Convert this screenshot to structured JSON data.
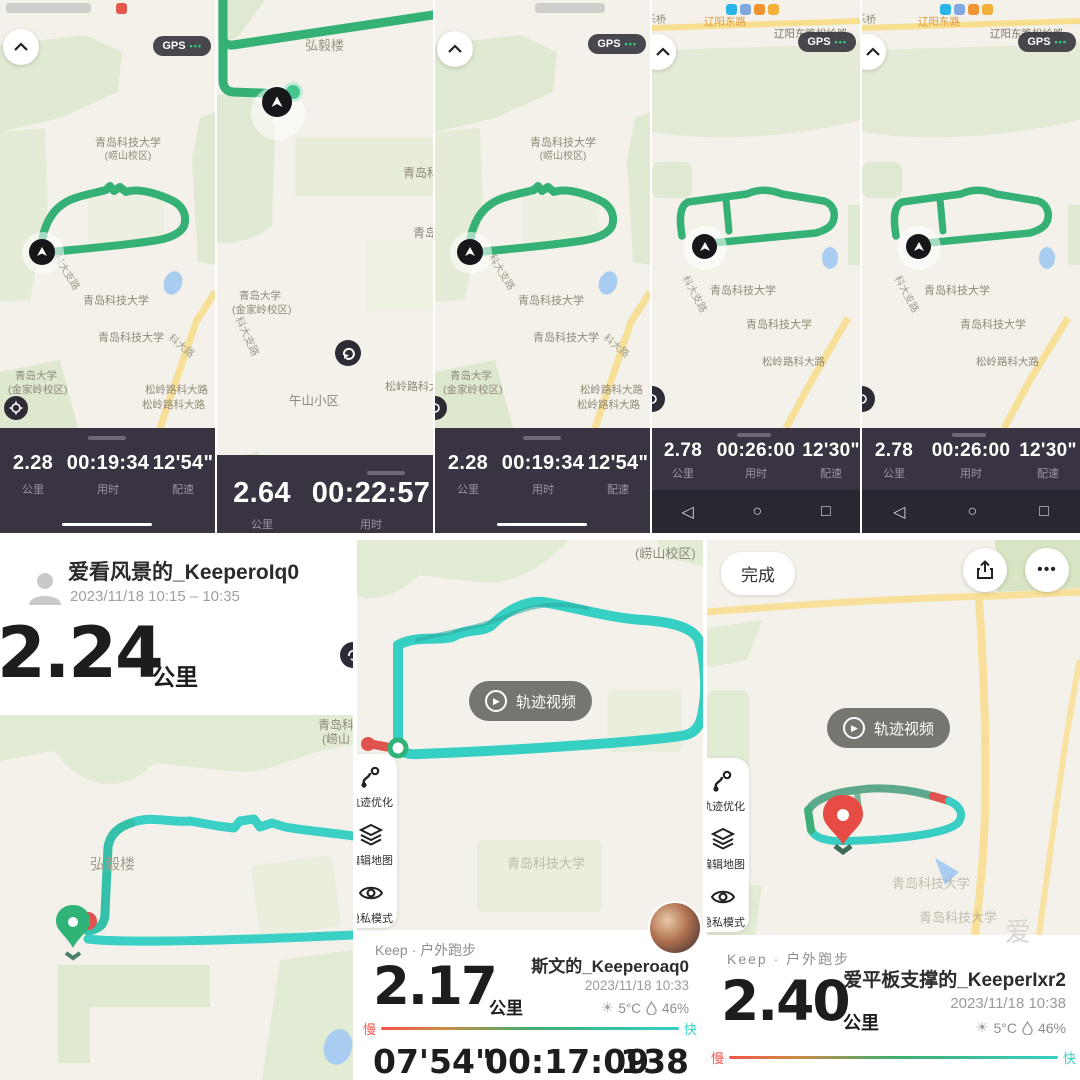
{
  "colors": {
    "keep_green": "#36b176",
    "track_cyan": "#35d0c5",
    "stats_bg": "#3a3442",
    "accent_red": "#f4524a",
    "map_bg": "#f4f1ea",
    "road_yellow": "#f7e09a"
  },
  "p1": {
    "gps": "GPS",
    "dots": "•••",
    "campus1": "青岛科技大学",
    "campus2": "(崂山校区)",
    "uni_a": "青岛科技大学",
    "uni_b": "青岛科技大学",
    "qdu_a": "青岛大学",
    "qdu_b": "(金家岭校区)",
    "road_kedazhilu": "科大支路",
    "road_kedalu": "科大路",
    "road_songling_a": "松岭路科大路",
    "road_songling_b": "松岭路科大路",
    "dist": "2.28",
    "dist_label": "公里",
    "dur": "00:19:34",
    "dur_label": "用时",
    "pace": "12'54\"",
    "pace_label": "配速"
  },
  "p2": {
    "building": "弘毅楼",
    "uni_right": "青岛科技大",
    "uni_cut": "青岛大",
    "qdu_a": "青岛大学",
    "qdu_b": "(金家岭校区)",
    "road_kedazhilu": "科大支路",
    "village": "午山小区",
    "road_songling": "松岭路科大路",
    "dist": "2.64",
    "dist_label": "公里",
    "dur": "00:22:57",
    "dur_label": "用时"
  },
  "p3": {
    "gps": "GPS",
    "dots": "•••",
    "campus1": "青岛科技大学",
    "campus2": "(崂山校区)",
    "uni_a": "青岛科技大学",
    "uni_b": "青岛科技大学",
    "qdu_a": "青岛大学",
    "qdu_b": "(金家岭校区)",
    "road_kedazhilu": "科大支路",
    "road_kedalu": "科大路",
    "road_songling_a": "松岭路科大路",
    "road_songling_b": "松岭路科大路",
    "dist": "2.28",
    "dist_label": "公里",
    "dur": "00:19:34",
    "dur_label": "用时",
    "pace": "12'54\"",
    "pace_label": "配速"
  },
  "p4": {
    "left_road": "乐桥",
    "road_top": "辽阳东路",
    "road_top2": "辽阳东路松岭路",
    "gps": "GPS",
    "dots": "•••",
    "uni_a": "青岛科技大学",
    "uni_b": "青岛科技大学",
    "road_kedazhilu": "科大支路",
    "road_songling": "松岭路科大路",
    "dist": "2.78",
    "dist_label": "公里",
    "dur": "00:26:00",
    "dur_label": "用时",
    "pace": "12'30\"",
    "pace_label": "配速",
    "nav_back": "◁",
    "nav_home": "○",
    "nav_recent": "□"
  },
  "p5": {
    "left_road": "乐桥",
    "road_top": "辽阳东路",
    "road_top2": "辽阳东路松岭路",
    "gps": "GPS",
    "dots": "•••",
    "uni_a": "青岛科技大学",
    "uni_b": "青岛科技大学",
    "road_kedazhilu": "科大支路",
    "road_songling": "松岭路科大路",
    "dist": "2.78",
    "dist_label": "公里",
    "dur": "00:26:00",
    "dur_label": "用时",
    "pace": "12'30\"",
    "pace_label": "配速",
    "nav_back": "◁",
    "nav_home": "○",
    "nav_recent": "□"
  },
  "b1": {
    "username": "爱看风景的_KeeperoIq0",
    "daterange": "2023/11/18 10:15 – 10:35",
    "dist": "2.24",
    "dist_label": "公里",
    "building": "弘毅楼",
    "corner1": "青岛科",
    "corner2": "(崂山"
  },
  "b2": {
    "corner": "(崂山校区)",
    "video_label": "轨迹视频",
    "play": "▶",
    "btn_route": "轨迹优化",
    "btn_map": "编辑地图",
    "btn_privacy": "隐私模式",
    "uni": "青岛科技大学",
    "app_line": "Keep · 户外跑步",
    "dist": "2.17",
    "dist_label": "公里",
    "username": "斯文的_Keeperoaq0",
    "datetime": "2023/11/18 10:33",
    "sun": "☀",
    "temp": "5°C",
    "hum": "46%",
    "slow": "慢",
    "fast": "快",
    "pace": "07'54\"",
    "dur": "00:17:09",
    "hr": "138"
  },
  "b3": {
    "done": "完成",
    "more": "•••",
    "video_label": "轨迹视频",
    "play": "▶",
    "btn_route": "轨迹优化",
    "btn_map": "编辑地图",
    "btn_privacy": "隐私模式",
    "uni_a": "青岛科技大学",
    "uni_b": "青岛科技大学",
    "watermark": "爱",
    "app_line": "Keep · 户外跑步",
    "dist": "2.40",
    "dist_label": "公里",
    "username": "爱平板支撑的_KeeperIxr2",
    "datetime": "2023/11/18 10:38",
    "sun": "☀",
    "temp": "5°C",
    "hum": "46%",
    "slow": "慢",
    "fast": "快"
  }
}
